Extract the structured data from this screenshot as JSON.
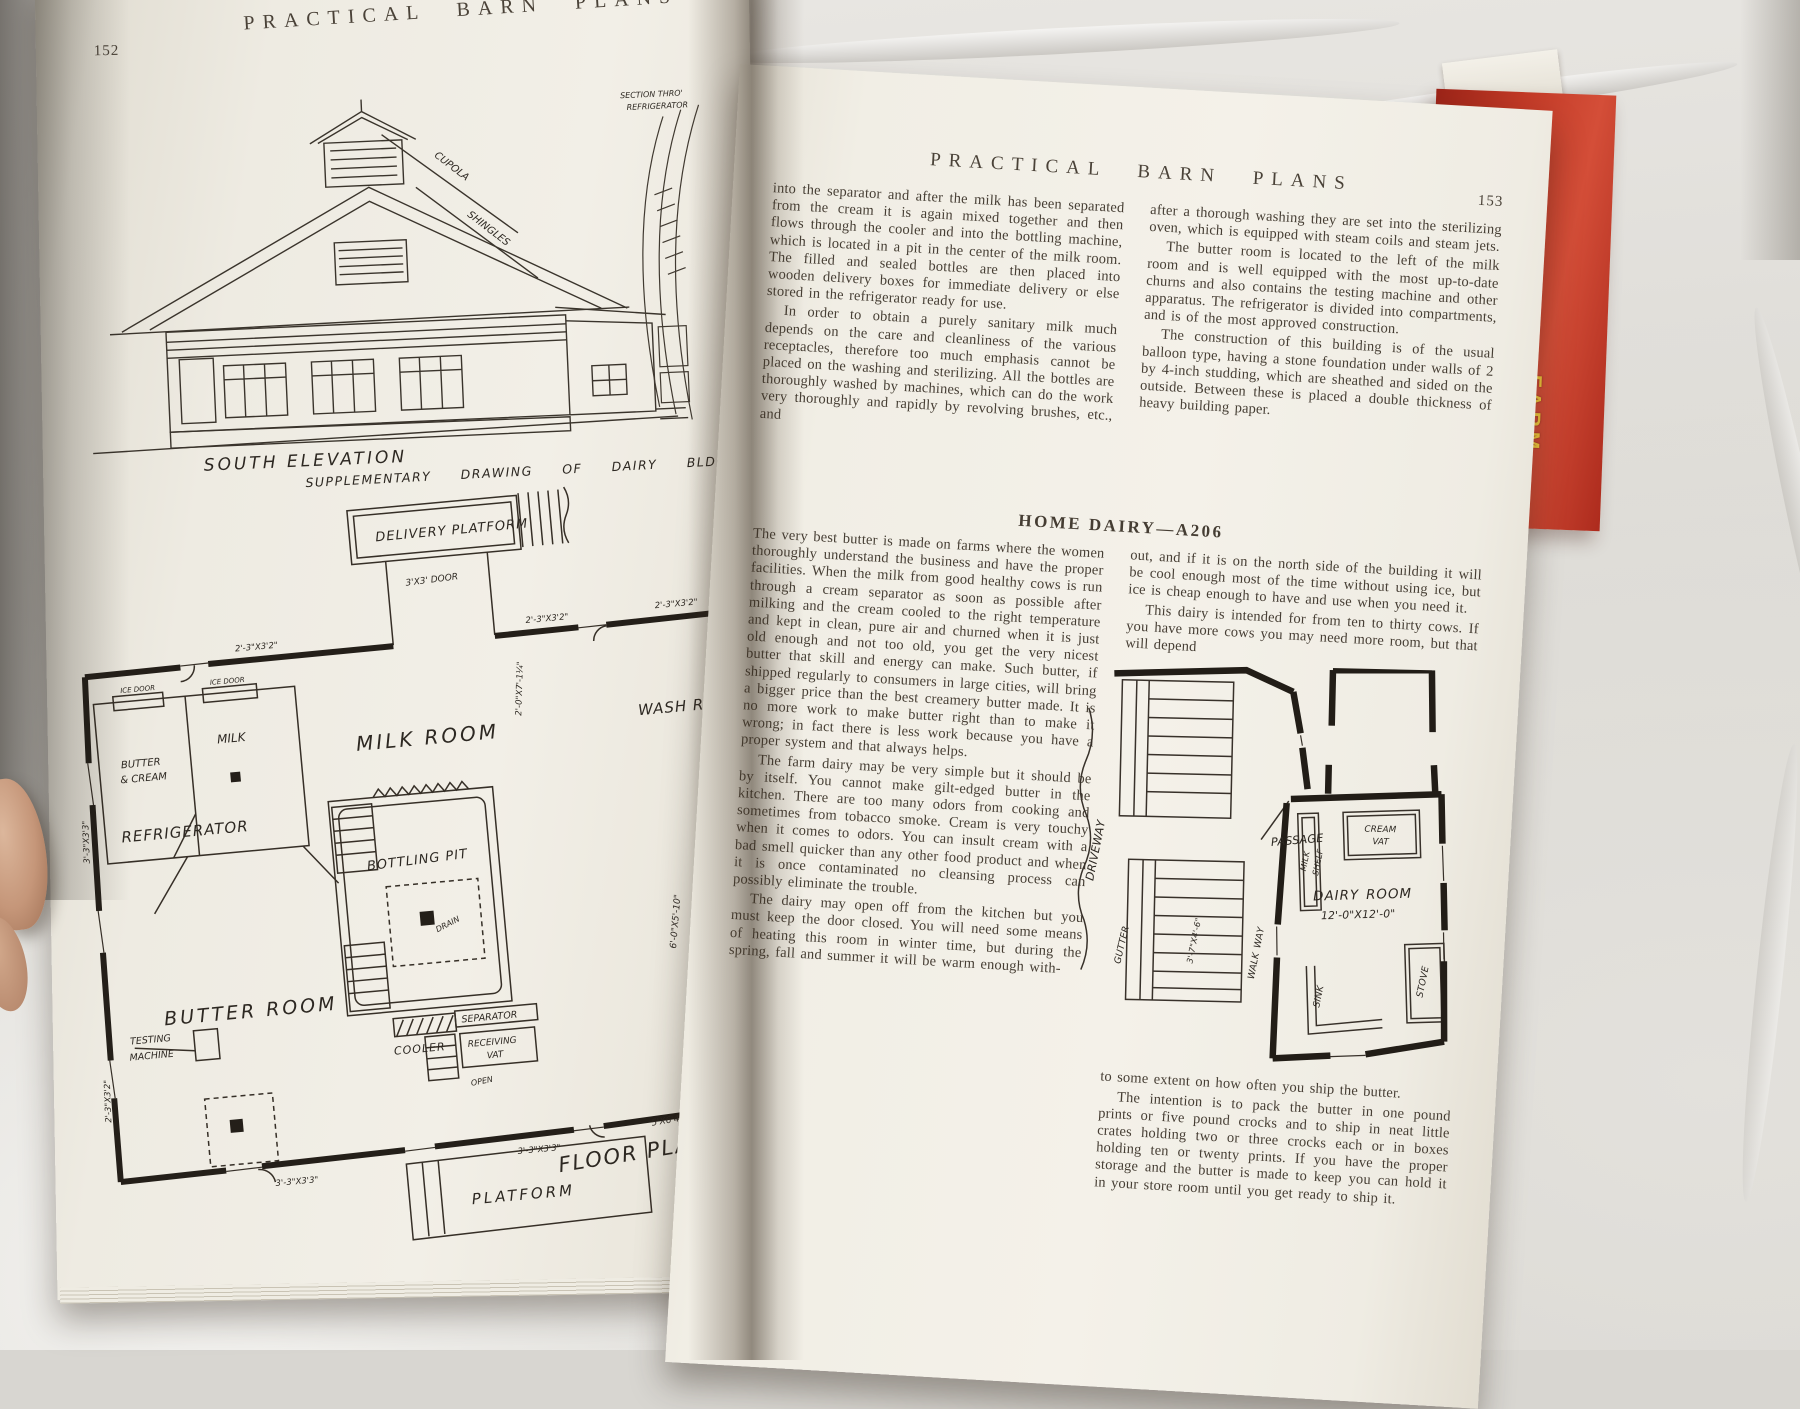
{
  "photo": {
    "spine_label": "FARM"
  },
  "lp": {
    "no": "152",
    "header": "PRACTICAL BARN PLANS",
    "note1": "CUPOLA",
    "note2": "SHINGLES",
    "sec1": "SECTION THRO'",
    "sec2": "REFRIGERATOR",
    "elev_caption": "SOUTH ELEVATION",
    "supp_caption": "SUPPLEMENTARY DRAWING OF DAIRY BLDG.",
    "plan": {
      "platform_top": "DELIVERY PLATFORM",
      "door_top": "3'X3' DOOR",
      "dim_wall": "2'-3\"X3'2\"",
      "ice": "ICE DOOR",
      "milk": "MILK",
      "butter1": "BUTTER",
      "butter2": "& CREAM",
      "refrig": "REFRIGERATOR",
      "milk_room": "MILK ROOM",
      "wash_room": "WASH ROOM",
      "dim_v1": "2'-0\"X7'-1¼\"",
      "pit": "BOTTLING PIT",
      "drain": "DRAIN",
      "cooler": "COOLER",
      "butter_room": "BUTTER ROOM",
      "separator": "SEPARATOR",
      "recv1": "RECEIVING",
      "recv2": "VAT",
      "open": "OPEN",
      "testing1": "TESTING",
      "testing2": "MACHINE",
      "dim_v2": "6'-0\"X5'-10\"",
      "sink": "SINK",
      "dim_w2": "3'-3\"X3'3\"",
      "dim_w3": "5'X6'4\"",
      "platform_bottom": "PLATFORM",
      "caption": "FLOOR PLAN OF DAIRY"
    }
  },
  "rp": {
    "no": "153",
    "header": "PRACTICAL BARN PLANS",
    "heading": "HOME DAIRY—A206",
    "c1t": [
      "into the separator and after the milk has been separated from the cream it is again mixed together and then flows through the cooler and into the bottling machine, which is located in a pit in the center of the milk room.  The filled and sealed bottles are then placed into wooden delivery boxes for immediate delivery or else stored in the refrigerator ready for use.",
      "In order to obtain a purely sanitary milk much depends on the care and cleanliness of the various receptacles, therefore too much emphasis cannot be placed on the washing and sterilizing.  All the bottles are thoroughly washed by machines, which can do the work very thoroughly and rapidly by revolving brushes, etc., and"
    ],
    "c2t": [
      "after a thorough washing they are set into the sterilizing oven, which is equipped with steam coils and steam jets.",
      "The butter room is located to the left of the milk room and is well equipped with the most up-to-date churns and also contains the testing machine and other apparatus.  The refrigerator is divided into compartments, and is of the most approved construction.",
      "The construction of this building is of the usual balloon type, having a stone foundation under walls of 2 by 4-inch studding, which are sheathed and sided on the outside.  Between these is placed a double thickness of heavy building paper."
    ],
    "c1b": [
      "The very best butter is made on farms where the women thoroughly understand the business and have the proper facilities. When the milk from good healthy cows is run through a cream separator as soon as possible after milking and the cream cooled to the right temperature and kept in clean, pure air and churned when it is just old enough and not too old, you get the very nicest butter that skill and energy can make.  Such butter, if shipped regularly to consumers in large cities, will bring a bigger price than the best creamery butter made.  It is no more work to make butter right than to make it wrong; in fact there is less work because you have a proper system and that always helps.",
      "The farm dairy may be very simple but it should be by itself.  You cannot make gilt-edged butter in the kitchen.  There are too many odors from cooking and sometimes from tobacco smoke.  Cream is very touchy when it comes to odors.  You can insult cream with a bad smell quicker than any other food product and when it is once contaminated no cleansing process can possibly eliminate the trouble.",
      "The dairy may open off from the kitchen but you must keep the door closed.  You will need some means of heating this room in winter time, but during the spring, fall and summer it will be warm enough with-"
    ],
    "c2m": [
      "out, and if it is on the north side of the building it will be cool enough most of the time without using ice, but ice is cheap enough to have and use when you need it.",
      "This dairy is intended for from ten to thirty cows.  If you have more cows you may need more room, but that will depend"
    ],
    "c2b": [
      "to some extent on how often you ship the butter.",
      "The intention is to pack the butter in one pound prints or five pound crocks and to ship in neat little crates holding two or three crocks each or in boxes holding ten or twenty prints. If you have the proper storage and the butter is made to keep you can hold it in your store room until you get ready to ship it."
    ],
    "plan": {
      "driveway": "DRIVEWAY",
      "passage": "PASSAGE",
      "gutter": "GUTTER",
      "walkway": "WALK WAY",
      "stall_dim": "3'-7\"X4'-6\"",
      "shelf1": "MILK",
      "shelf2": "SHELF",
      "vat1": "CREAM",
      "vat2": "VAT",
      "room": "DAIRY ROOM",
      "room_dim": "12'-0\"X12'-0\"",
      "sink": "SINK",
      "stove": "STOVE"
    }
  }
}
